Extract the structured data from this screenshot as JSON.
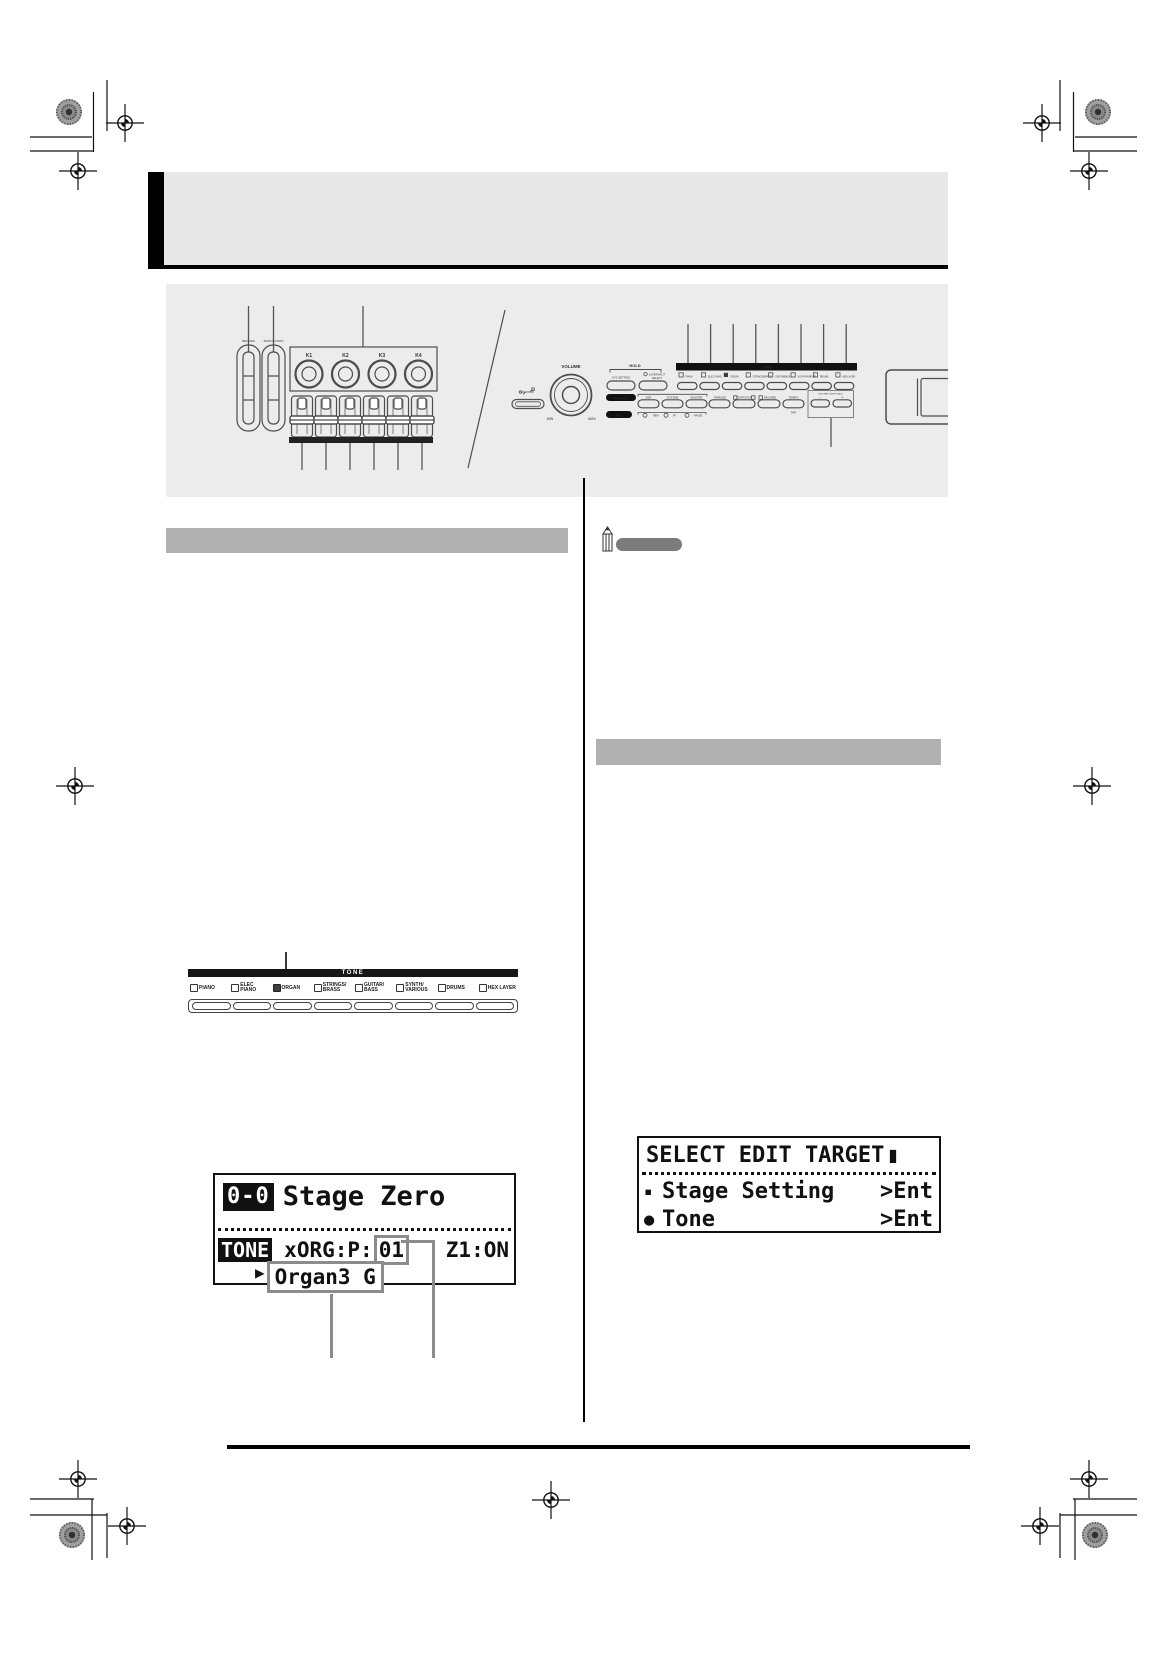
{
  "page_type": "printed manual page (keyboard owner's guide)",
  "colors": {
    "chapter_bar": "#e8e8e8",
    "panel_figure_bg": "#ececec",
    "section_bar": "#b1b1b1",
    "note_bar": "#7b7b7b",
    "lcd_ink": "#111111",
    "callout_gray": "#8c8c8c"
  },
  "panel": {
    "bender": "BENDER",
    "modulation": "MODULATION",
    "knobs": [
      "K1",
      "K2",
      "K3",
      "K4"
    ],
    "volume": "VOLUME",
    "min": "MIN",
    "max": "MAX",
    "hold": "HOLD",
    "sys_setting": "SYS SETTING",
    "layer_select_1": "LAYER/SPLIT",
    "layer_select_2": "SELECT",
    "balance": "BALANCE",
    "dsp": "DSP",
    "system": "SYSTEM",
    "master": "MASTER",
    "phrase": "PHRASE",
    "start_stop": "START/STOP",
    "record": "RECORD",
    "tempo": "TEMPO",
    "tap": "TAP",
    "edit_part": "EDIT/PART/STEP/TRACK",
    "minus": "−",
    "plus": "+",
    "midi": "MIDI",
    "rew": "REW",
    "ff": "FF",
    "pause": "PAUSE",
    "tone_bar": "TONE",
    "tone_labels": [
      "PIANO",
      "ELEC PIANO",
      "ORGAN",
      "STRINGS/BRASS",
      "GUITAR/BASS",
      "SYNTH/VARIOUS",
      "DRUMS",
      "HEX LAYER"
    ]
  },
  "tone_strip": {
    "header": "TONE",
    "items": [
      {
        "line1": "PIANO",
        "line2": "",
        "active": false
      },
      {
        "line1": "ELEC",
        "line2": "PIANO",
        "active": false
      },
      {
        "line1": "ORGAN",
        "line2": "",
        "active": true
      },
      {
        "line1": "STRINGS/",
        "line2": "BRASS",
        "active": false
      },
      {
        "line1": "GUITAR/",
        "line2": "BASS",
        "active": false
      },
      {
        "line1": "SYNTH/",
        "line2": "VARIOUS",
        "active": false
      },
      {
        "line1": "DRUMS",
        "line2": "",
        "active": false
      },
      {
        "line1": "HEX LAYER",
        "line2": "",
        "active": false
      }
    ]
  },
  "lcd_tone": {
    "badge": "0-0",
    "name": "Stage Zero",
    "row_label": "TONE",
    "tone_prefix": "xORG:P:",
    "tone_number": "01",
    "zone_status": "Z1:ON",
    "cursor": "▶",
    "tone_name": "Organ3 G"
  },
  "lcd_edit": {
    "title": "SELECT EDIT TARGET",
    "cursor": "▮",
    "items": [
      {
        "marker": "▪",
        "label": "Stage Setting",
        "action": ">Ent"
      },
      {
        "marker": "●",
        "label": "Tone",
        "action": ">Ent"
      }
    ]
  }
}
